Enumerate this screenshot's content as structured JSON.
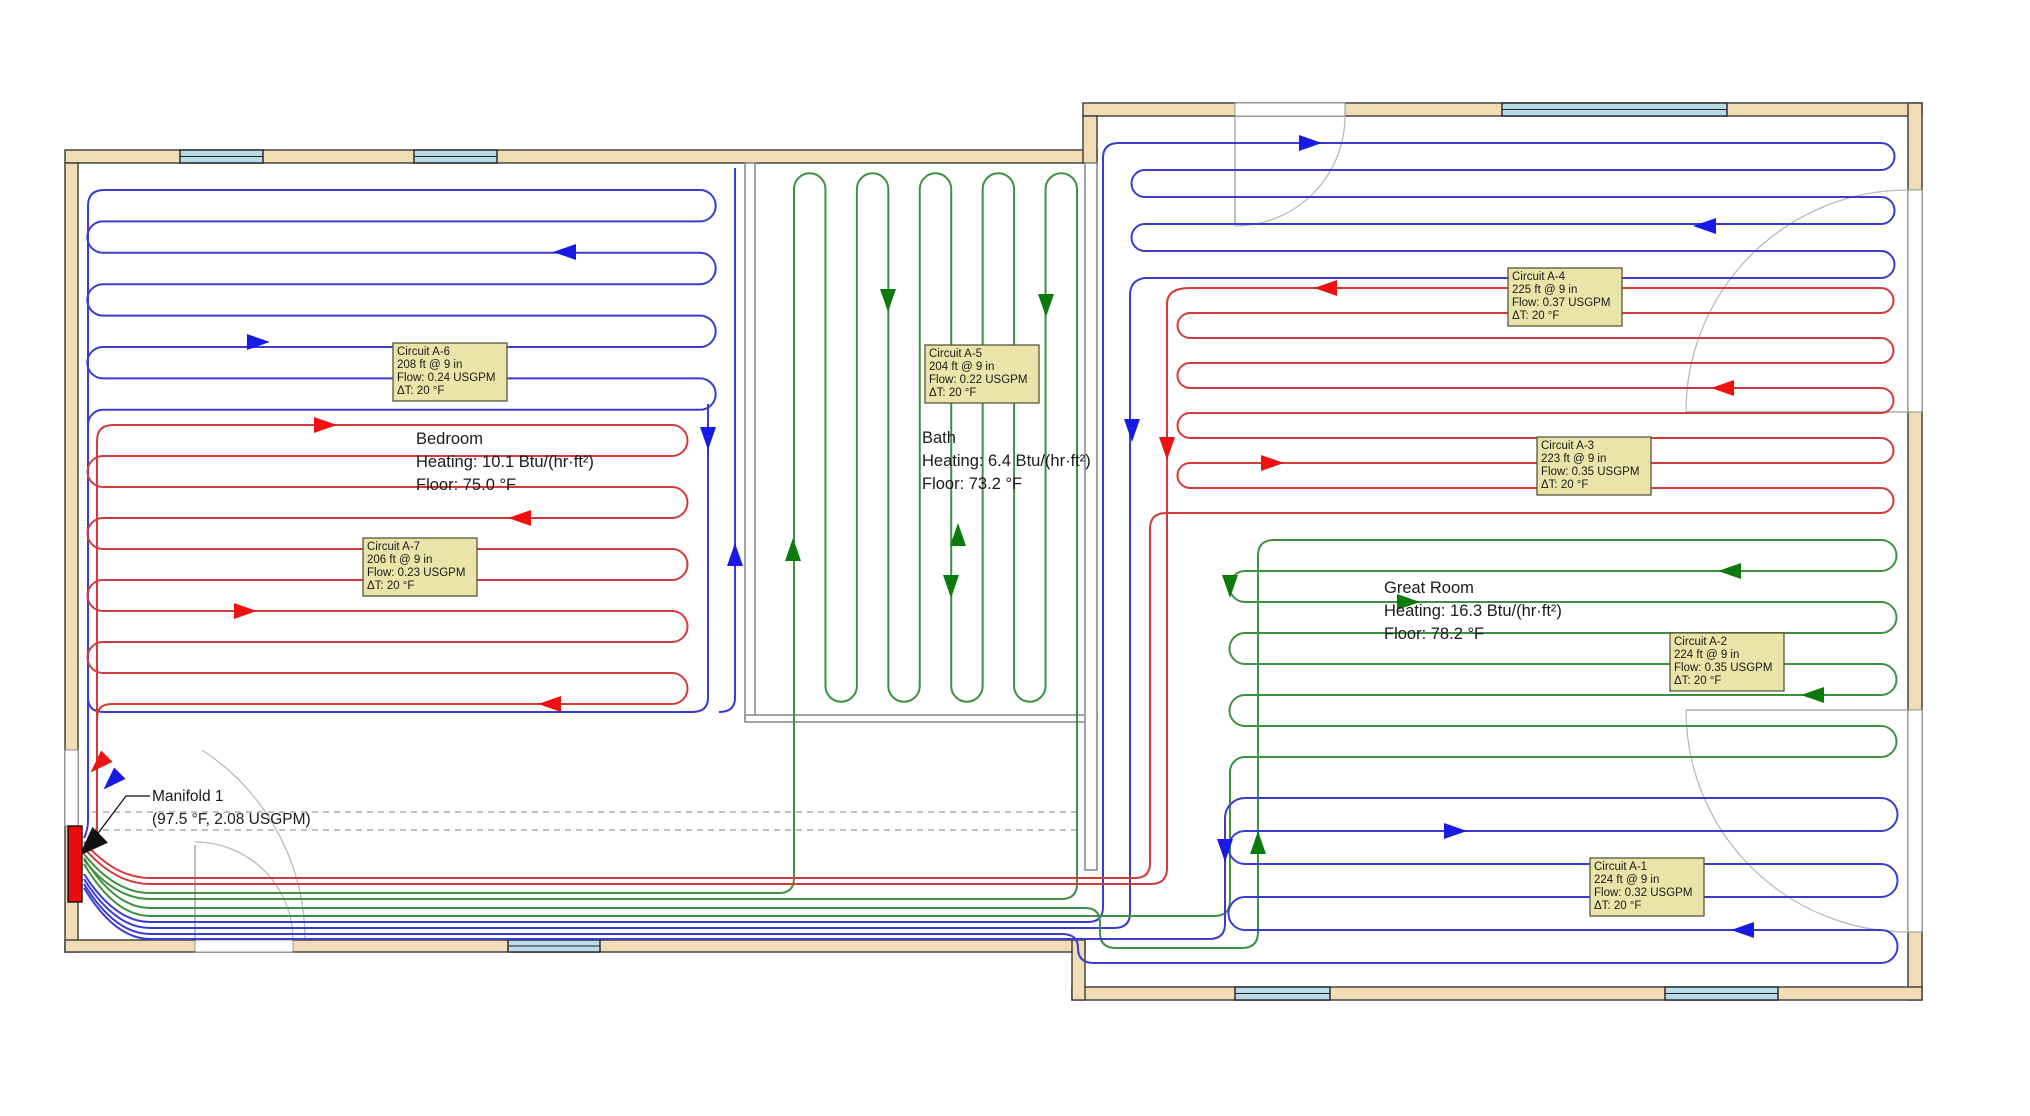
{
  "manifold": {
    "name": "Manifold 1",
    "detail": "(97.5 °F, 2.08 USGPM)"
  },
  "rooms": {
    "bedroom": {
      "name": "Bedroom",
      "heating": "Heating: 10.1 Btu/(hr·ft²)",
      "floor": "Floor: 75.0 °F"
    },
    "bath": {
      "name": "Bath",
      "heating": "Heating: 6.4 Btu/(hr·ft²)",
      "floor": "Floor: 73.2 °F"
    },
    "great_room": {
      "name": "Great Room",
      "heating": "Heating: 16.3 Btu/(hr·ft²)",
      "floor": "Floor: 78.2 °F"
    }
  },
  "circuits": {
    "a1": {
      "name": "Circuit A-1",
      "length": "224 ft @ 9 in",
      "flow": "Flow: 0.32 USGPM",
      "dt": "ΔT: 20 °F"
    },
    "a2": {
      "name": "Circuit A-2",
      "length": "224 ft @ 9 in",
      "flow": "Flow: 0.35 USGPM",
      "dt": "ΔT: 20 °F"
    },
    "a3": {
      "name": "Circuit A-3",
      "length": "223 ft @ 9 in",
      "flow": "Flow: 0.35 USGPM",
      "dt": "ΔT: 20 °F"
    },
    "a4": {
      "name": "Circuit A-4",
      "length": "225 ft @ 9 in",
      "flow": "Flow: 0.37 USGPM",
      "dt": "ΔT: 20 °F"
    },
    "a5": {
      "name": "Circuit A-5",
      "length": "204 ft @ 9 in",
      "flow": "Flow: 0.22 USGPM",
      "dt": "ΔT: 20 °F"
    },
    "a6": {
      "name": "Circuit A-6",
      "length": "208 ft @ 9 in",
      "flow": "Flow: 0.24 USGPM",
      "dt": "ΔT: 20 °F"
    },
    "a7": {
      "name": "Circuit A-7",
      "length": "206 ft @ 9 in",
      "flow": "Flow: 0.23 USGPM",
      "dt": "ΔT: 20 °F"
    }
  },
  "colors": {
    "pipe_red": "#d43a3a",
    "pipe_blue": "#3b3bd2",
    "pipe_green": "#3d9140",
    "arrow_red": "#ee1111",
    "arrow_blue": "#1a1ae6",
    "arrow_green": "#0d7a0d",
    "wall": "#f0ddb6",
    "window": "#b9dbe8",
    "label_bg": "#ebe4a8",
    "manifold": "#e80c0c"
  }
}
